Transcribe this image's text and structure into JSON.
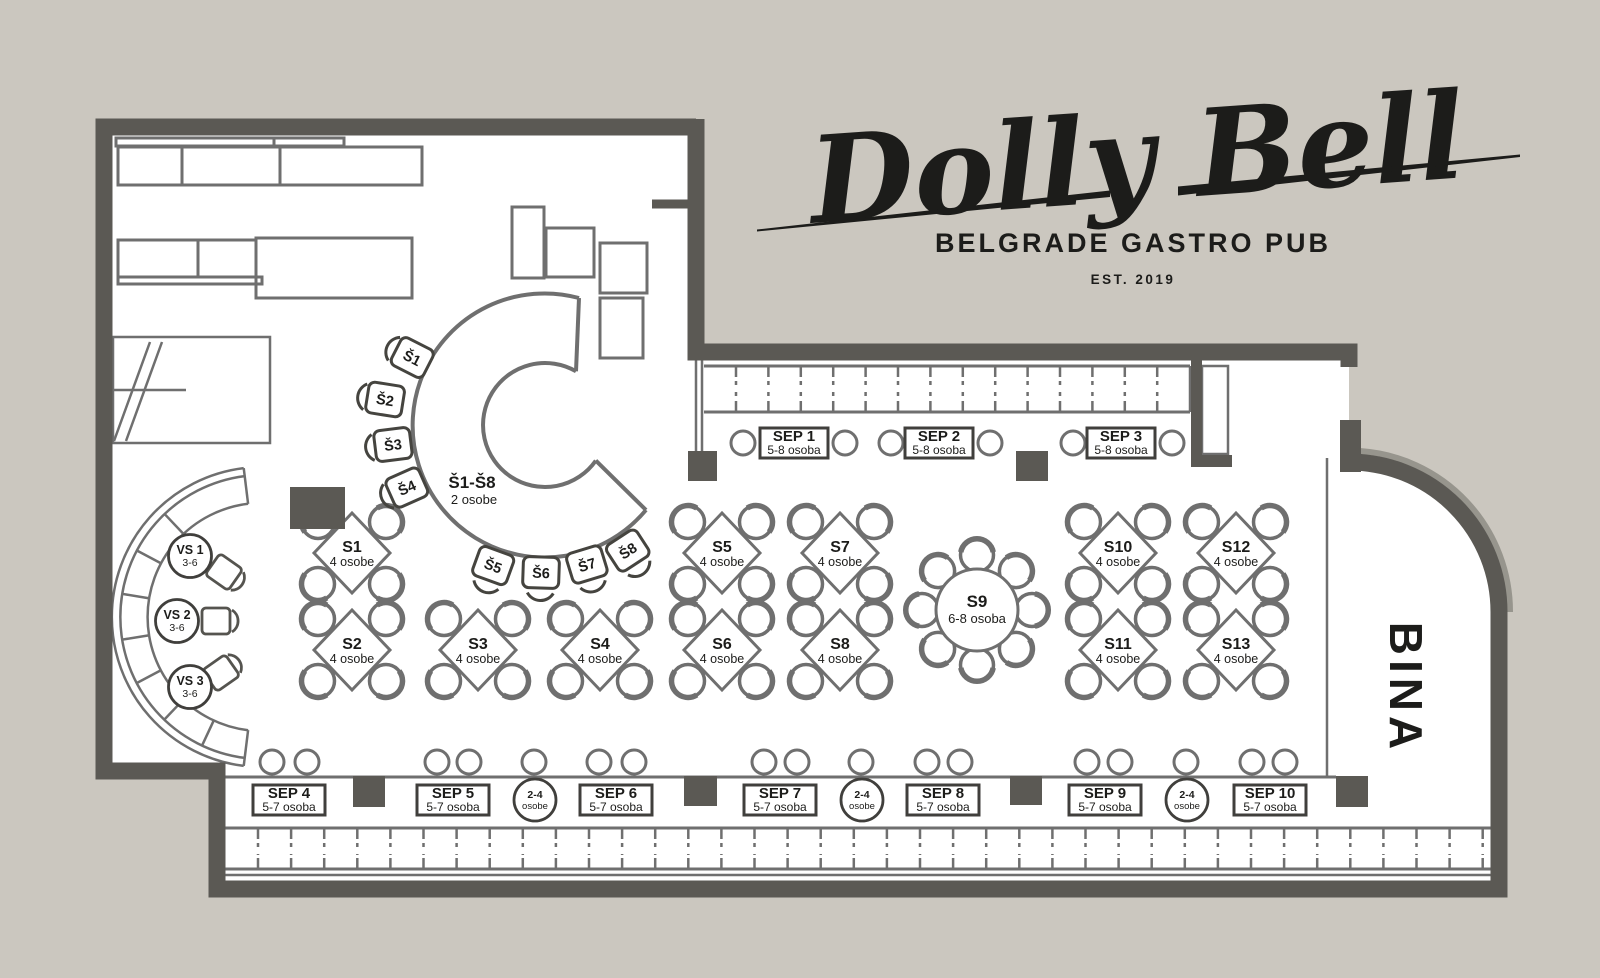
{
  "brand": {
    "title": "Dolly Bell",
    "subtitle": "BELGRADE GASTRO PUB",
    "established": "EST. 2019"
  },
  "stage": {
    "label": "BINA"
  },
  "bar": {
    "label": "Š1-Š8",
    "capacity": "2 osobe",
    "stools": [
      "Š1",
      "Š2",
      "Š3",
      "Š4",
      "Š5",
      "Š6",
      "Š7",
      "Š8"
    ]
  },
  "round_table": {
    "id": "S9",
    "capacity": "6-8 osoba"
  },
  "square_tables": [
    {
      "id": "S1",
      "capacity": "4 osobe"
    },
    {
      "id": "S2",
      "capacity": "4 osobe"
    },
    {
      "id": "S3",
      "capacity": "4 osobe"
    },
    {
      "id": "S4",
      "capacity": "4 osobe"
    },
    {
      "id": "S5",
      "capacity": "4 osobe"
    },
    {
      "id": "S6",
      "capacity": "4 osobe"
    },
    {
      "id": "S7",
      "capacity": "4 osobe"
    },
    {
      "id": "S8",
      "capacity": "4 osobe"
    },
    {
      "id": "S10",
      "capacity": "4 osobe"
    },
    {
      "id": "S11",
      "capacity": "4 osobe"
    },
    {
      "id": "S12",
      "capacity": "4 osobe"
    },
    {
      "id": "S13",
      "capacity": "4 osobe"
    }
  ],
  "booths_top": [
    {
      "id": "SEP 1",
      "capacity": "5-8 osoba"
    },
    {
      "id": "SEP 2",
      "capacity": "5-8 osoba"
    },
    {
      "id": "SEP 3",
      "capacity": "5-8 osoba"
    }
  ],
  "booths_bottom": [
    {
      "id": "SEP 4",
      "capacity": "5-7 osoba"
    },
    {
      "id": "SEP 5",
      "capacity": "5-7 osoba"
    },
    {
      "id": "SEP 6",
      "capacity": "5-7 osoba"
    },
    {
      "id": "SEP 7",
      "capacity": "5-7 osoba"
    },
    {
      "id": "SEP 8",
      "capacity": "5-7 osoba"
    },
    {
      "id": "SEP 9",
      "capacity": "5-7 osoba"
    },
    {
      "id": "SEP 10",
      "capacity": "5-7 osoba"
    }
  ],
  "small_round_tables": [
    {
      "line1": "2-4",
      "line2": "osobe"
    },
    {
      "line1": "2-4",
      "line2": "osobe"
    },
    {
      "line1": "2-4",
      "line2": "osobe"
    }
  ],
  "lounge_tables": [
    {
      "id": "VS 1",
      "capacity": "3-6"
    },
    {
      "id": "VS 2",
      "capacity": "3-6"
    },
    {
      "id": "VS 3",
      "capacity": "3-6"
    }
  ]
}
